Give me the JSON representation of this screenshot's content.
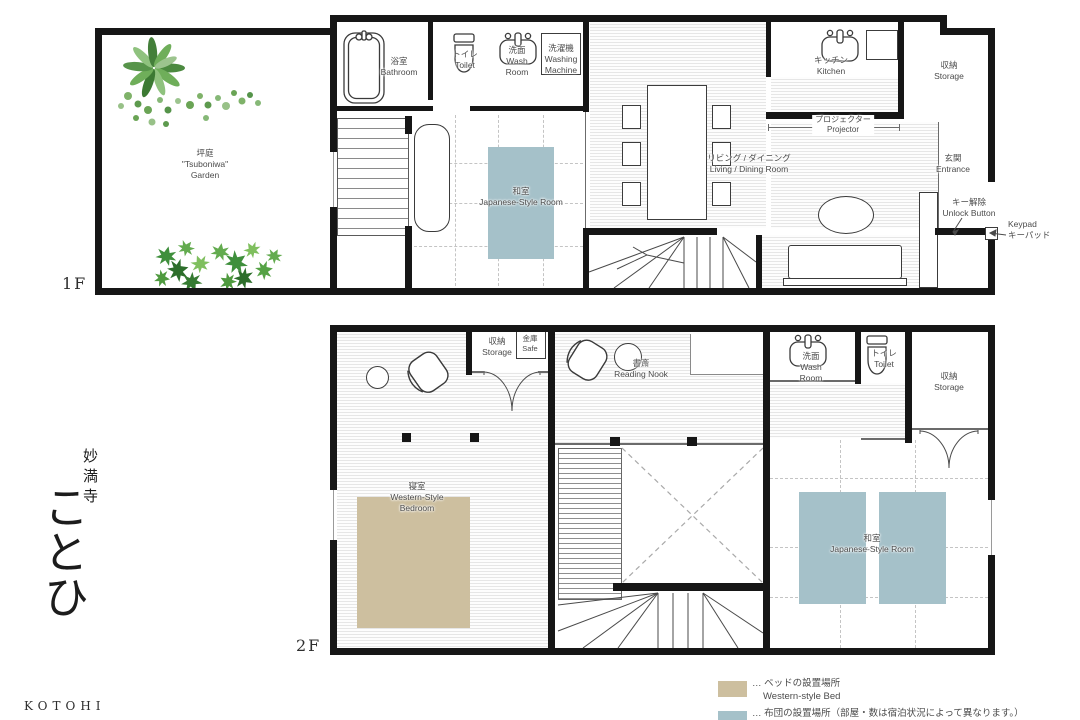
{
  "branding": {
    "temple": "妙満寺",
    "name": "ことひ",
    "roman": "KOTOHI"
  },
  "floor1": {
    "label": "1F",
    "garden": {
      "jp": "坪庭",
      "en1": "\"Tsuboniwa\"",
      "en2": "Garden"
    },
    "bathroom": {
      "jp": "浴室",
      "en": "Bathroom"
    },
    "toilet": {
      "jp": "トイレ",
      "en": "Toilet"
    },
    "washroom": {
      "jp": "洗面",
      "en1": "Wash",
      "en2": "Room"
    },
    "washing_machine": {
      "jp": "洗濯機",
      "en1": "Washing",
      "en2": "Machine"
    },
    "kitchen": {
      "jp": "キッチン",
      "en": "Kitchen"
    },
    "storage": {
      "jp": "収納",
      "en": "Storage"
    },
    "projector": {
      "jp": "プロジェクター",
      "en": "Projector"
    },
    "living": {
      "jp": "リビング / ダイニング",
      "en": "Living / Dining Room"
    },
    "japanese_room": {
      "jp": "和室",
      "en": "Japanese-Style Room"
    },
    "entrance": {
      "jp": "玄関",
      "en": "Entrance"
    },
    "unlock_button": {
      "jp": "キー解除",
      "en": "Unlock Button"
    },
    "keypad": {
      "en": "Keypad",
      "jp": "キーパッド"
    }
  },
  "floor2": {
    "label": "2F",
    "closet": {
      "jp": "収納",
      "en": "Storage"
    },
    "safe": {
      "jp": "金庫",
      "en": "Safe"
    },
    "reading_nook": {
      "jp": "書斎",
      "en": "Reading Nook"
    },
    "washroom": {
      "jp": "洗面",
      "en1": "Wash",
      "en2": "Room"
    },
    "toilet": {
      "jp": "トイレ",
      "en": "Toilet"
    },
    "storage": {
      "jp": "収納",
      "en": "Storage"
    },
    "bedroom": {
      "jp": "寝室",
      "en1": "Western-Style",
      "en2": "Bedroom"
    },
    "japanese_room": {
      "jp": "和室",
      "en": "Japanese-Style Room"
    }
  },
  "legend": {
    "bed": {
      "jp": "… ベッドの設置場所",
      "en": "Western-style Bed",
      "color": "#cdbf9f"
    },
    "futon": {
      "jp": "… 布団の設置場所（部屋・数は宿泊状況によって異なります。）",
      "color": "#a5c1c9"
    }
  },
  "colors": {
    "wall": "#161616",
    "bed_area": "#cdbf9f",
    "futon_area": "#a5c1c9"
  }
}
